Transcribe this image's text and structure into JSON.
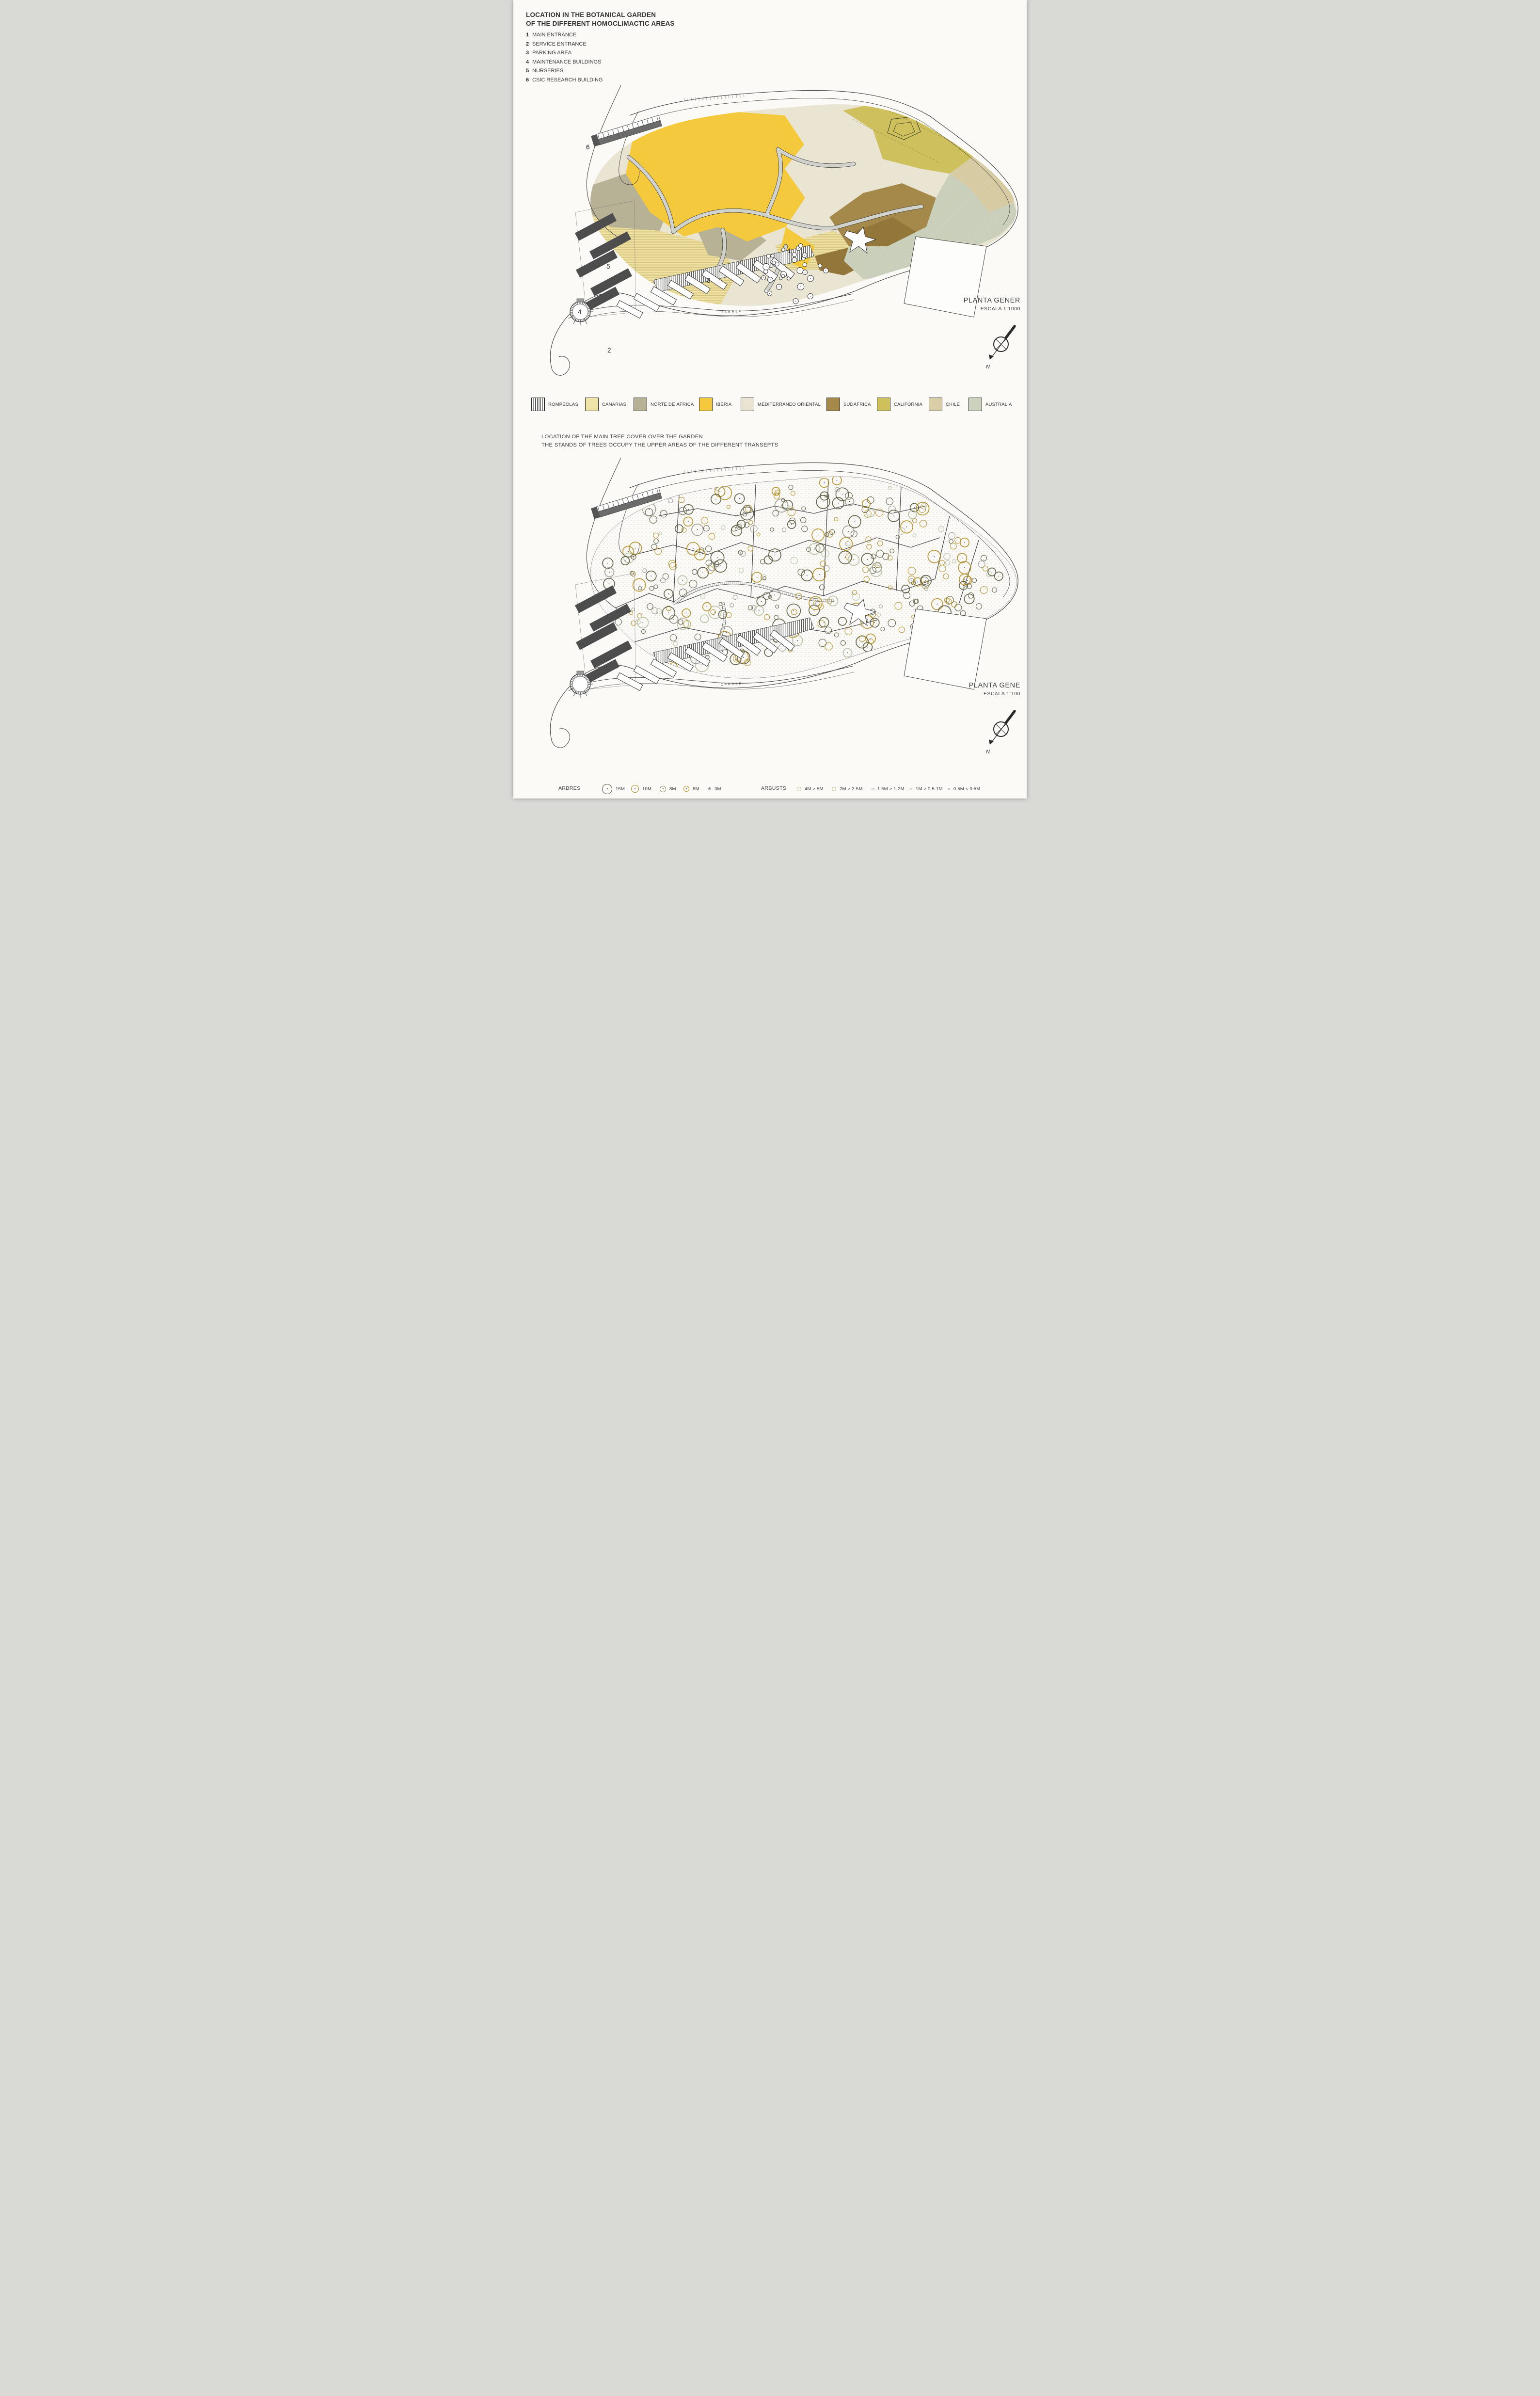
{
  "section1": {
    "title_line1": "LOCATION IN THE BOTANICAL GARDEN",
    "title_line2": "OF THE DIFFERENT HOMOCLIMACTIC AREAS",
    "key_items": [
      {
        "num": "1",
        "label": "MAIN ENTRANCE"
      },
      {
        "num": "2",
        "label": "SERVICE ENTRANCE"
      },
      {
        "num": "3",
        "label": "PARKING AREA"
      },
      {
        "num": "4",
        "label": "MAINTENANCE BUILDINGS"
      },
      {
        "num": "5",
        "label": "NURSERIES"
      },
      {
        "num": "6",
        "label": "CSIC RESEARCH BUILDING"
      }
    ],
    "plan": {
      "title": "PLANTA GENER",
      "scale": "ESCALA 1:1000"
    },
    "compass_label": "N",
    "carrer_label": "CARRER",
    "legend": [
      {
        "label": "ROMPEOLAS",
        "color": "#fdfdfb",
        "pattern": "vlines"
      },
      {
        "label": "CANARIAS",
        "color": "#efe3a6",
        "pattern": "hlines"
      },
      {
        "label": "NORTE DE ÁFRICA",
        "color": "#b7b196",
        "pattern": ""
      },
      {
        "label": "IBERIA",
        "color": "#f4c93c",
        "pattern": ""
      },
      {
        "label": "MEDITERRÁNEO ORIENTAL",
        "color": "#e9e5d2",
        "pattern": ""
      },
      {
        "label": "SUDÁFRICA",
        "color": "#a5894a",
        "pattern": ""
      },
      {
        "label": "CALIFORNIA",
        "color": "#cfc05e",
        "pattern": ""
      },
      {
        "label": "CHILE",
        "color": "#d9cda6",
        "pattern": ""
      },
      {
        "label": "AUSTRALIA",
        "color": "#ccd2bd",
        "pattern": "diag"
      }
    ]
  },
  "section2": {
    "title_line1": "LOCATION OF THE MAIN TREE COVER OVER THE GARDEN",
    "title_line2": "THE STANDS OF TREES OCCUPY THE UPPER AREAS OF THE DIFFERENT TRANSEPTS",
    "plan": {
      "title": "PLANTA GENE",
      "scale": "ESCALA 1:100"
    },
    "compass_label": "N",
    "tree_legend": {
      "arbres_label": "ARBRES",
      "arbusts_label": "ARBUSTS",
      "trees": [
        {
          "label": "15M",
          "d": 21,
          "color": "#4b4b35",
          "bw": 1.6,
          "dot": true
        },
        {
          "label": "10M",
          "d": 16,
          "color": "#a8861f",
          "bw": 1.6,
          "dot": true
        },
        {
          "label": "8M",
          "d": 13,
          "color": "#8c8c5a",
          "bw": 1.3,
          "dot": true
        },
        {
          "label": "6M",
          "d": 12,
          "color": "#b5941f",
          "bw": 1.5,
          "dot": true
        },
        {
          "label": "3M",
          "d": 6,
          "color": "#8a8a8a",
          "bw": 1.1,
          "dot": true
        }
      ],
      "shrubs": [
        {
          "label": "4M > 5M",
          "d": 9,
          "color": "#c9c9a4",
          "bw": 1.6,
          "dot": false
        },
        {
          "label": "2M > 2-5M",
          "d": 9,
          "color": "#adb37f",
          "bw": 1.6,
          "dot": false
        },
        {
          "label": "1.5M > 1-2M",
          "d": 5,
          "color": "#a9a9a9",
          "bw": 1.3,
          "dot": false
        },
        {
          "label": "1M > 0.5-1M",
          "d": 5,
          "color": "#a9a9a9",
          "bw": 1.3,
          "dot": false
        },
        {
          "label": "0.5M < 0.5M",
          "d": 4,
          "color": "#a9a9a9",
          "bw": 1.1,
          "dot": false
        }
      ]
    }
  },
  "colors": {
    "iberia": "#f4c93c",
    "canarias": "#efe3a6",
    "norte": "#b7b196",
    "mediterraneo": "#e9e5d2",
    "sudafrica": "#a5894a",
    "sudafrica_dark": "#93763a",
    "california": "#cfc05e",
    "chile": "#d9cda6",
    "australia": "#ccd2bd",
    "building_dark": "#4d4d4d",
    "tree_gold": "#b3912a",
    "tree_olive": "#5d5d44",
    "tree_sage": "#b7c0a2",
    "tree_gray": "#9a9a92"
  }
}
